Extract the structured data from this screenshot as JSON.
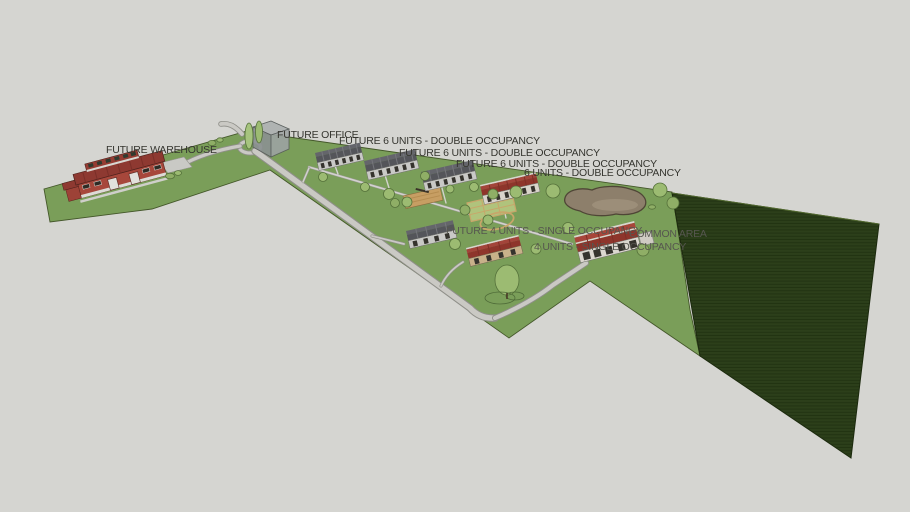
{
  "view": {
    "type": "3d-site-plan-viewport",
    "description": "Sketch-style 3D aerial rendering of a housing site plan"
  },
  "labels": {
    "future_warehouse": "FUTURE WAREHOUSE",
    "future_office": "FUTURE OFFICE",
    "future_6_units_1": "FUTURE 6 UNITS - DOUBLE OCCUPANCY",
    "future_6_units_2": "FUTURE 6 UNITS - DOUBLE OCCUPANCY",
    "future_6_units_3": "FUTURE 6 UNITS - DOUBLE OCCUPANCY",
    "six_units": "6 UNITS - DOUBLE OCCUPANCY",
    "future_4_units": "FUTURE 4 UNITS - SINGLE OCCUPANCY",
    "common_area": "COMMON AREA",
    "four_units": "4 UNITS - SINGLE OCCUPANCY"
  },
  "colors": {
    "background": "#d5d5d1",
    "grass": "#7a9e59",
    "field_dark": "#2c3f1a",
    "road": "#cac9c4",
    "road_edge": "#8f8f89",
    "sidewalk": "#d3d2ce",
    "roof_red": "#953c32",
    "wall_red": "#a7473b",
    "roof_grey": "#54555a",
    "wall_grey": "#c9c9c6",
    "wall_tan": "#c8b18a",
    "pond_fill": "#8d7f6b",
    "tree_green": "#9cbb72",
    "label_dark": "#35352f",
    "label_grey": "#56564f"
  }
}
